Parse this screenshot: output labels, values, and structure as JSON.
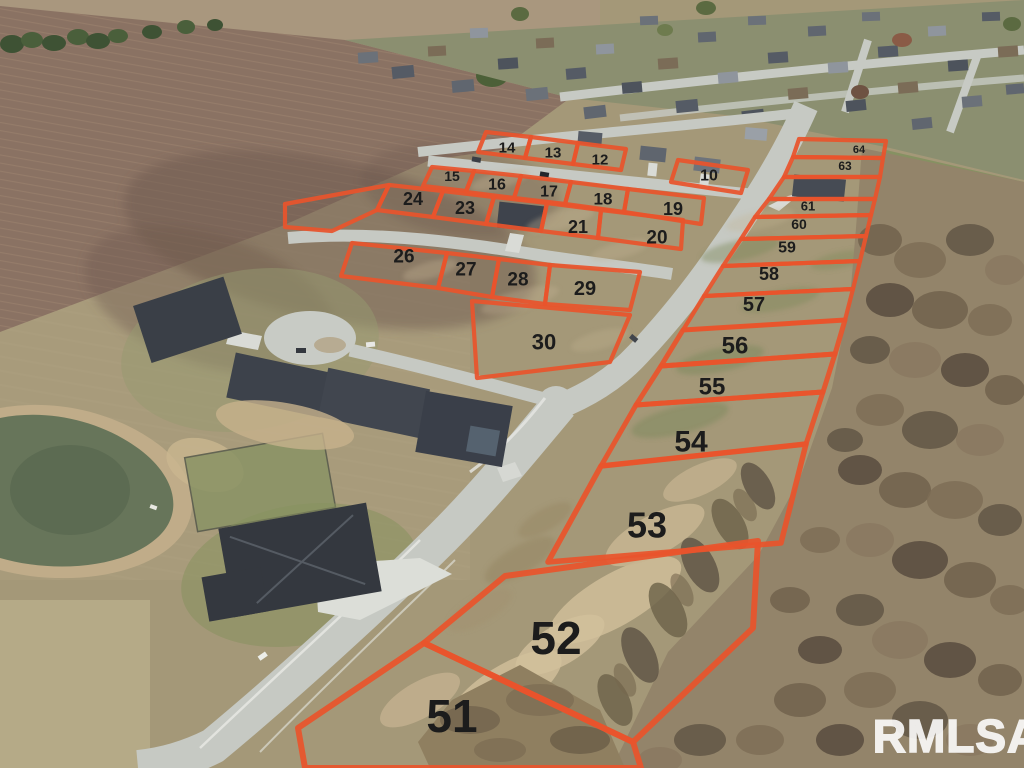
{
  "watermark": {
    "text": "RMLSA",
    "color": "#ffffff"
  },
  "overlay": {
    "line_color": "#e8542c",
    "label_color": "#1c1c1c"
  },
  "lots": [
    {
      "label": "14",
      "points": "486,132 531,137 525,158 478,152",
      "lx": 507,
      "ly": 148,
      "fs": 15
    },
    {
      "label": "13",
      "points": "531,137 578,143 573,164 525,158",
      "lx": 553,
      "ly": 153,
      "fs": 15
    },
    {
      "label": "12",
      "points": "578,143 626,149 621,170 573,164",
      "lx": 600,
      "ly": 160,
      "fs": 15
    },
    {
      "label": "10",
      "points": "678,160 748,170 741,193 671,182",
      "lx": 709,
      "ly": 176,
      "fs": 16
    },
    {
      "label": "15",
      "points": "432,167 474,171 466,191 423,186",
      "lx": 452,
      "ly": 176,
      "fs": 14
    },
    {
      "label": "16",
      "points": "474,171 521,176 514,198 466,192",
      "lx": 497,
      "ly": 185,
      "fs": 16
    },
    {
      "label": "17",
      "points": "521,176 571,182 565,204 514,198",
      "lx": 549,
      "ly": 192,
      "fs": 16
    },
    {
      "label": "18",
      "points": "571,182 628,189 624,212 565,204",
      "lx": 603,
      "ly": 199,
      "fs": 17
    },
    {
      "label": "19",
      "points": "628,189 704,198 701,224 624,212",
      "lx": 673,
      "ly": 209,
      "fs": 18
    },
    {
      "label": "24",
      "points": "389,185 443,191 433,217 377,210",
      "lx": 413,
      "ly": 199,
      "fs": 18
    },
    {
      "label": "23",
      "points": "443,191 494,197 486,224 433,217",
      "lx": 465,
      "ly": 208,
      "fs": 18
    },
    {
      "label": "",
      "points": "494,197 547,203 541,231 486,224"
    },
    {
      "label": "21",
      "points": "547,203 601,210 598,238 541,231",
      "lx": 578,
      "ly": 227,
      "fs": 18
    },
    {
      "label": "20",
      "points": "601,210 683,220 681,249 598,238",
      "lx": 657,
      "ly": 238,
      "fs": 19
    },
    {
      "label": "",
      "points": "285,204 389,185 377,210 332,231 285,227"
    },
    {
      "label": "26",
      "points": "352,243 447,253 438,288 341,276",
      "lx": 404,
      "ly": 257,
      "fs": 19
    },
    {
      "label": "27",
      "points": "447,253 499,259 492,297 438,288",
      "lx": 466,
      "ly": 270,
      "fs": 19
    },
    {
      "label": "28",
      "points": "499,259 550,265 545,304 492,297",
      "lx": 518,
      "ly": 280,
      "fs": 19
    },
    {
      "label": "29",
      "points": "550,265 640,272 630,310 545,304",
      "lx": 585,
      "ly": 289,
      "fs": 20
    },
    {
      "label": "30",
      "points": "472,301 630,315 610,362 477,378",
      "lx": 544,
      "ly": 342,
      "fs": 22
    },
    {
      "label": "64",
      "points": "799,139 886,141 883,158 793,157",
      "lx": 859,
      "ly": 150,
      "fs": 11
    },
    {
      "label": "63",
      "points": "793,157 883,158 880,177 784,177",
      "lx": 845,
      "ly": 166,
      "fs": 12
    },
    {
      "label": "",
      "points": "784,177 880,177 875,199 769,199"
    },
    {
      "label": "61",
      "points": "769,199 875,199 871,215 755,217",
      "lx": 808,
      "ly": 206,
      "fs": 13
    },
    {
      "label": "60",
      "points": "755,217 871,215 866,236 741,239",
      "lx": 799,
      "ly": 224,
      "fs": 14
    },
    {
      "label": "59",
      "points": "741,239 866,236 860,261 723,266",
      "lx": 787,
      "ly": 248,
      "fs": 16
    },
    {
      "label": "58",
      "points": "723,266 860,261 853,289 704,296",
      "lx": 769,
      "ly": 274,
      "fs": 18
    },
    {
      "label": "57",
      "points": "704,296 853,289 845,320 683,330",
      "lx": 754,
      "ly": 305,
      "fs": 20
    },
    {
      "label": "56",
      "points": "683,330 845,320 835,354 661,366",
      "lx": 735,
      "ly": 346,
      "fs": 24,
      "sw": 5
    },
    {
      "label": "55",
      "points": "661,366 835,354 823,392 636,405",
      "lx": 712,
      "ly": 387,
      "fs": 24,
      "sw": 5
    },
    {
      "label": "54",
      "points": "636,405 823,392 806,444 601,466",
      "lx": 691,
      "ly": 442,
      "fs": 30,
      "sw": 5
    },
    {
      "label": "53",
      "points": "601,466 806,444 781,543 548,562",
      "lx": 647,
      "ly": 525,
      "fs": 36,
      "sw": 5.5
    },
    {
      "label": "52",
      "points": "505,576 758,541 753,628 633,742 424,643",
      "lx": 556,
      "ly": 638,
      "fs": 46,
      "sw": 6
    },
    {
      "label": "51",
      "points": "298,728 424,643 633,742 641,768 305,768",
      "lx": 452,
      "ly": 716,
      "fs": 46,
      "sw": 6
    }
  ]
}
